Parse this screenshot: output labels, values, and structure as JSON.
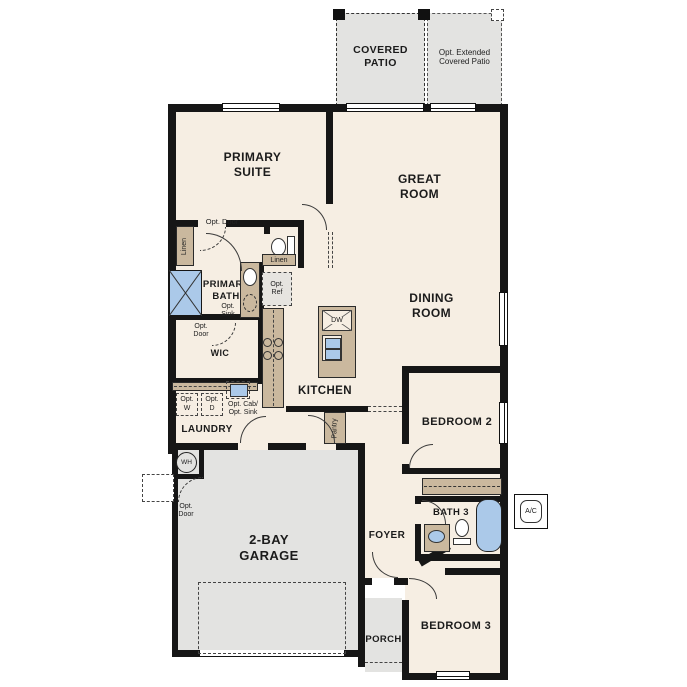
{
  "labels": {
    "covered_patio": "COVERED\nPATIO",
    "ext_patio": "Opt. Extended\nCovered Patio",
    "primary_suite": "PRIMARY\nSUITE",
    "great_room": "GREAT\nROOM",
    "dining_room": "DINING\nROOM",
    "primary_bath": "PRIMARY\nBATH",
    "wic": "WIC",
    "kitchen": "KITCHEN",
    "laundry": "LAUNDRY",
    "garage": "2-BAY\nGARAGE",
    "bedroom2": "BEDROOM 2",
    "foyer": "FOYER",
    "bath3": "BATH 3",
    "bedroom3": "BEDROOM 3",
    "porch": "PORCH"
  },
  "annotations": {
    "opt_door": "Opt. Door",
    "opt_door_2l": "Opt.\nDoor",
    "linen": "Linen",
    "opt_sink_2l": "Opt.\nSink",
    "opt_ref": "Opt.\nRef",
    "dw": "DW",
    "pantry": "Pantry",
    "opt_w": "Opt.\nW",
    "opt_d": "Opt.\nD",
    "opt_cab_sink": "Opt. Cab/\nOpt. Sink",
    "wh": "WH",
    "ac": "A/C"
  },
  "colors": {
    "floor": "#f6eee3",
    "outdoor": "#e3e3e1",
    "cabinet": "#cab89e",
    "fixture_blue": "#abc9e9",
    "wall": "#161616",
    "background": "#ffffff"
  }
}
